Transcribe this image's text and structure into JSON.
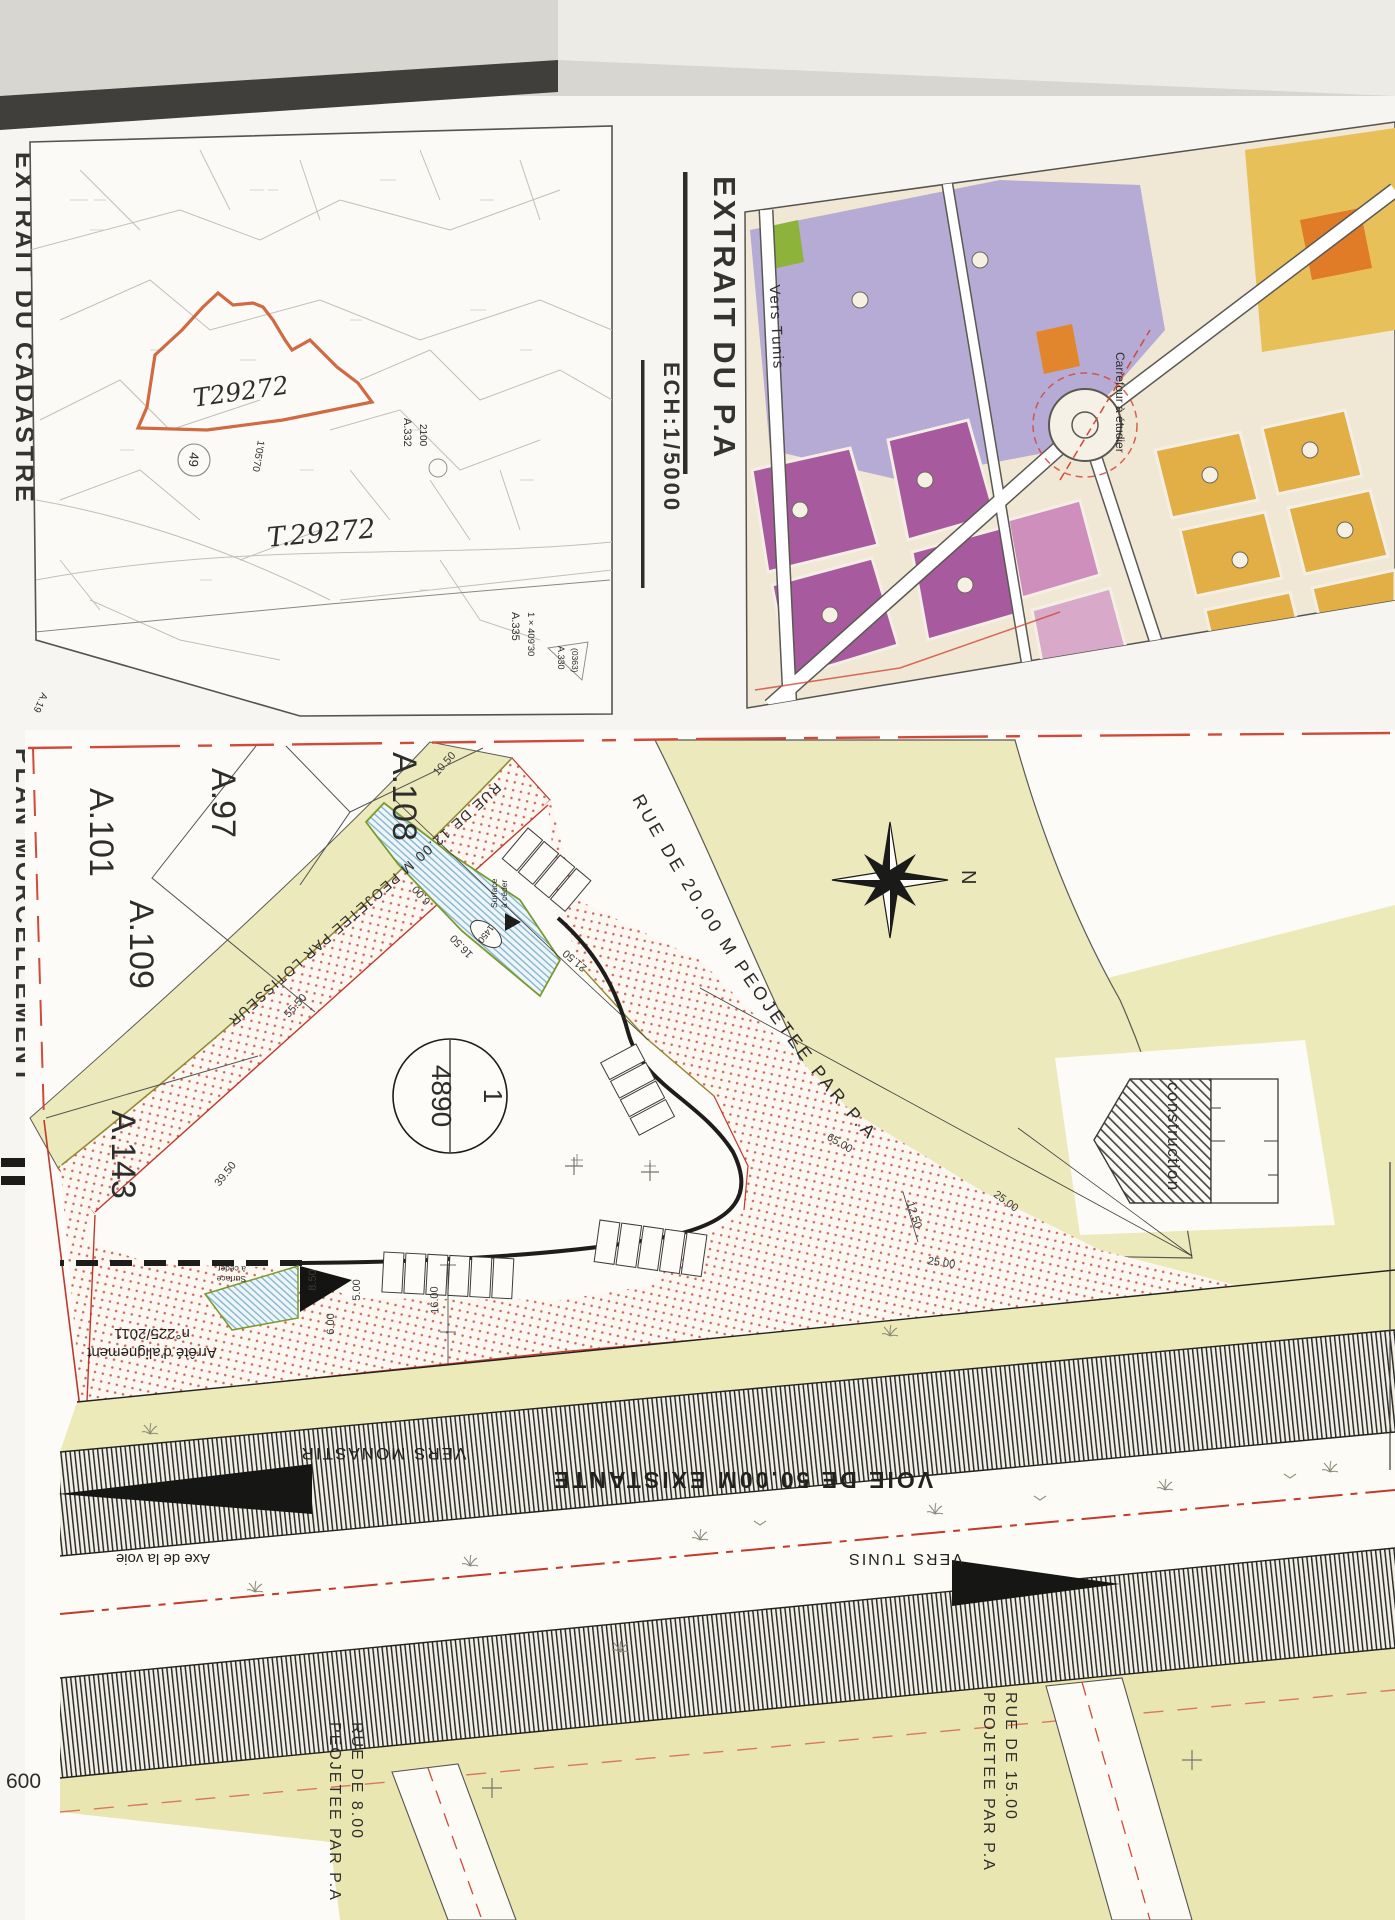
{
  "titles": {
    "cadastre": "EXTRAIT DU CADASTRE",
    "morcellement": "PLAN MORCELLEMENT",
    "pa": "EXTRAIT DU P.A",
    "scale": "ECH:1/5000"
  },
  "cadastre_map": {
    "parcel_outlined": "T29272",
    "parcel_label_2": "T.29272",
    "circled_number": "49",
    "a332": "A.332",
    "a332_num": "2100",
    "a335": "A.335",
    "a335_angle": "1 × 409'30",
    "a330": "A.330",
    "a330_num": "(0363)",
    "a19": "A.19",
    "angle_note": "1'05'70"
  },
  "pa_map": {
    "vers_tunis": "Vers Tunis",
    "carrefour": "Carrefour à étudier"
  },
  "plan": {
    "parcels": [
      "A.101",
      "A.97",
      "A.109",
      "A.108",
      "A.143"
    ],
    "lot": {
      "number": "1",
      "area": "4890",
      "oval": "1450"
    },
    "roads": {
      "r12": "RUE DE 12.00 M PEOJETEE PAR LOTISSEUR",
      "r20": "RUE DE 20.00 M PEOJETEE PAR P.A",
      "voie50": "VOIE DE 50.00M EXISTANTE",
      "r8_1": "RUE DE 8.00",
      "r8_2": "PEOJETEE PAR P.A",
      "r15_1": "RUE DE 15.00",
      "r15_2": "PEOJETEE PAR P.A"
    },
    "directions": {
      "monastir": "VERS MONASTIR",
      "tunis": "VERS TUNIS",
      "axe": "Axe de la voie",
      "north": "N"
    },
    "notes": {
      "arrete1": "Arrêté d'alignement",
      "arrete2": "n°225/2011",
      "construction": "construction",
      "surface1": "Surface",
      "surface2": "à céder"
    },
    "dimensions": [
      "55.50",
      "39.50",
      "10.50",
      "6.00",
      "16.50",
      "21.50",
      "65.00",
      "12.50",
      "25.00",
      "25.00",
      "8.50",
      "5.00",
      "6.00",
      "16.00",
      "29.00",
      "50.00"
    ],
    "page_number": "600"
  }
}
